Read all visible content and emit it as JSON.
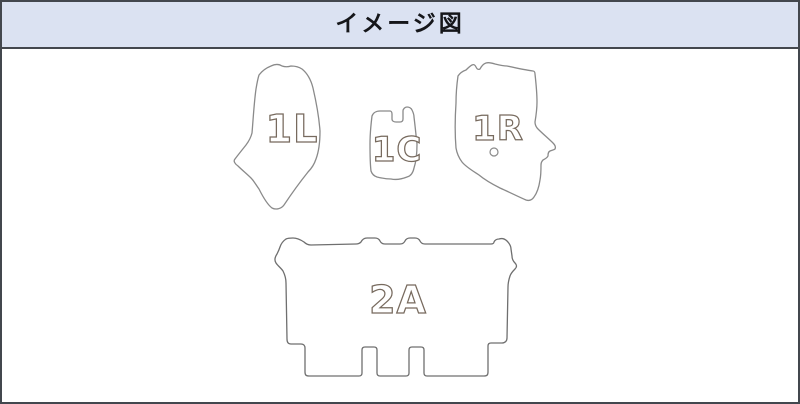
{
  "window": {
    "width_px": 800,
    "height_px": 404
  },
  "header": {
    "title": "イメージ図",
    "background_color": "#dbe2f2",
    "border_color": "#43474e"
  },
  "diagram": {
    "description_type": "car-floor-mat-set-outline-diagram",
    "outline_color": "#8a8a8a",
    "label_outline_color": "#776a5e",
    "background_color": "#ffffff",
    "mats": [
      {
        "label": "1L",
        "position": "front-left"
      },
      {
        "label": "1C",
        "position": "front-center"
      },
      {
        "label": "1R",
        "position": "front-right",
        "grommet_hole": true
      },
      {
        "label": "2A",
        "position": "second-row-full-width"
      }
    ]
  }
}
